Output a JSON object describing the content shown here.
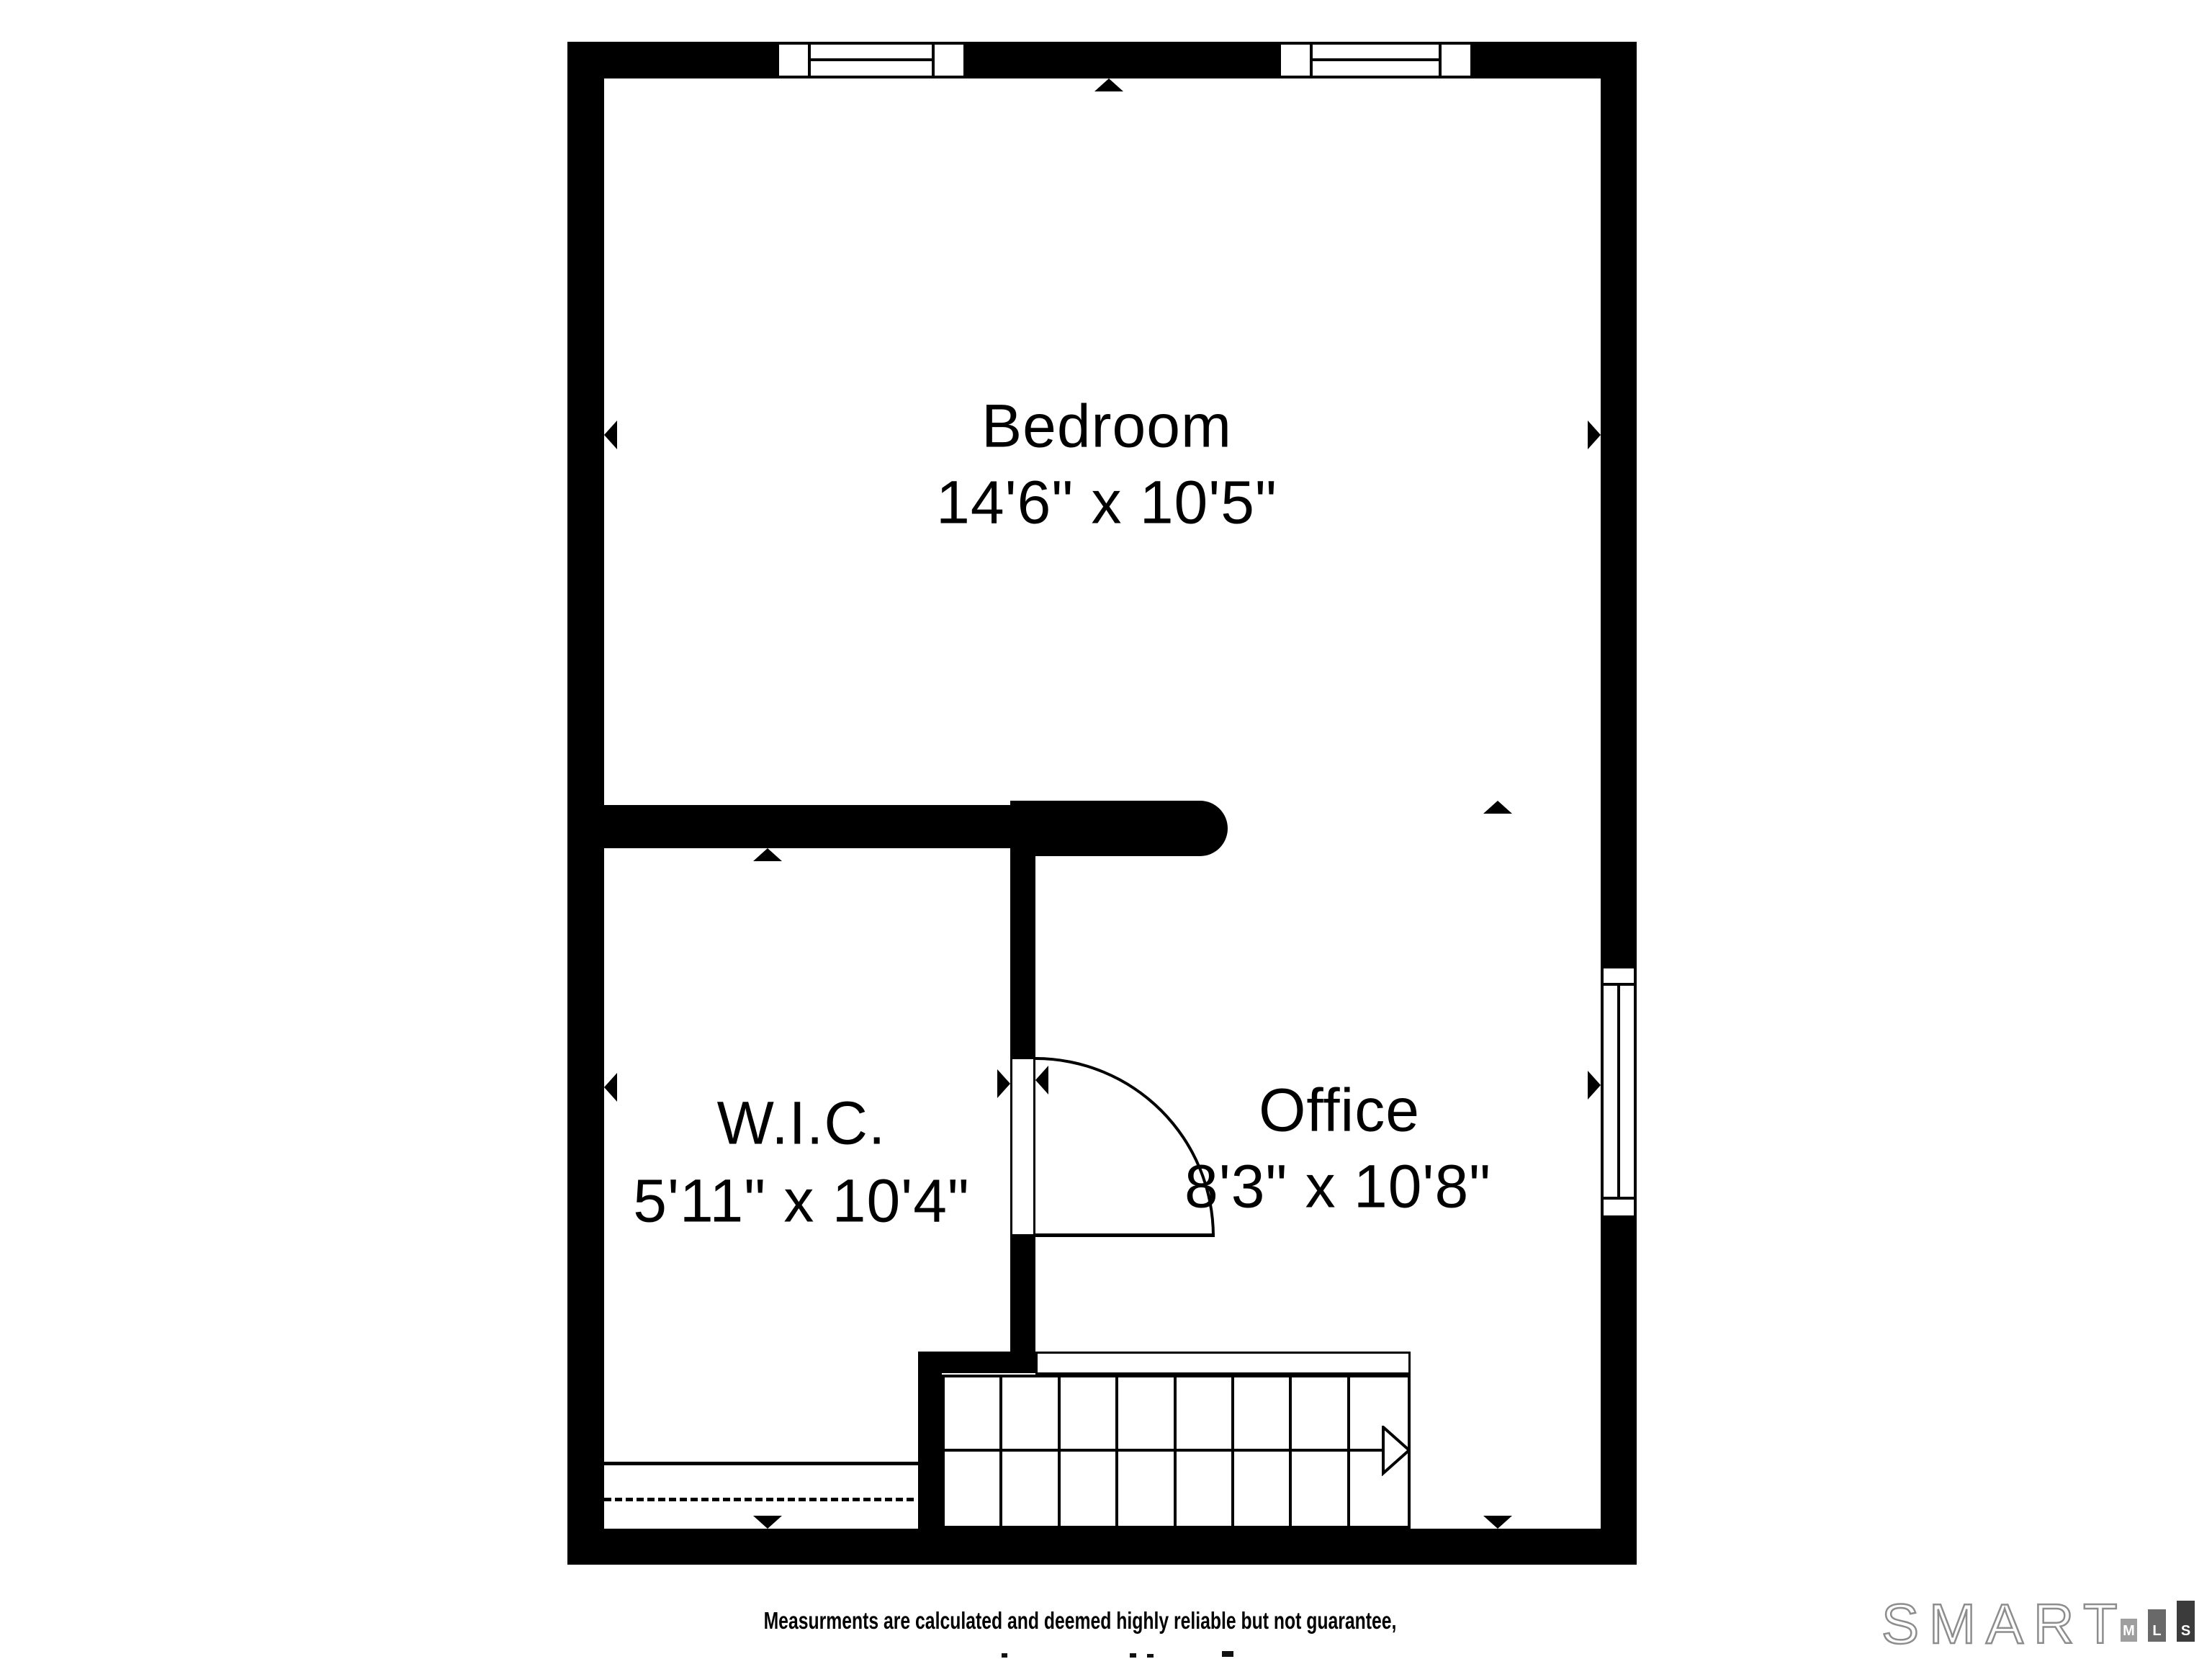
{
  "rooms": [
    {
      "name": "Bedroom",
      "dimensions": "14'6\" x 10'5\""
    },
    {
      "name": "W.I.C.",
      "dimensions": "5'11\" x 10'4\""
    },
    {
      "name": "Office",
      "dimensions": "8'3\" x 10'8\""
    }
  ],
  "disclaimer": "Measurments are calculated and deemed highly reliable but not guarantee,",
  "logo": {
    "brand": "SMART",
    "blocks": [
      {
        "letter": "M",
        "color": "#9e9e9e"
      },
      {
        "letter": "L",
        "color": "#696969"
      },
      {
        "letter": "S",
        "color": "#3b3b3b"
      }
    ]
  },
  "colors": {
    "walls": "#000000",
    "background": "#ffffff",
    "logo_outline": "#8d8d8d"
  }
}
